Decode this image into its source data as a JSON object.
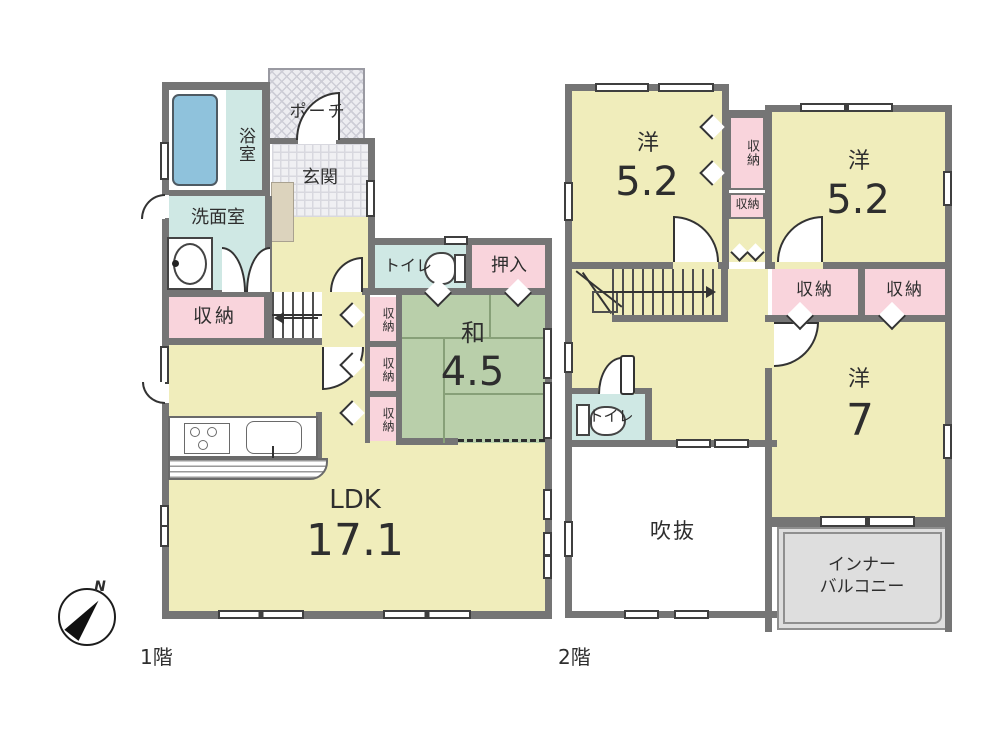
{
  "compass": {
    "north_label": "N"
  },
  "floor1": {
    "floor_label": "1階",
    "bath": "浴室",
    "washroom": "洗面室",
    "porch": "ポーチ",
    "entrance": "玄関",
    "toilet": "トイレ",
    "oshiire": "押入",
    "storage": "収納",
    "storage_small_1": "収納",
    "storage_small_2": "収納",
    "storage_small_3": "収納",
    "japanese_room": "和",
    "japanese_room_size": "4.5",
    "ldk": "LDK",
    "ldk_size": "17.1"
  },
  "floor2": {
    "floor_label": "2階",
    "western_a": "洋",
    "western_a_size": "5.2",
    "storage_tall": "収納",
    "storage_small": "収納",
    "western_b": "洋",
    "western_b_size": "5.2",
    "storage_a": "収納",
    "storage_b": "収納",
    "western_c": "洋",
    "western_c_size": "7",
    "toilet": "トイレ",
    "void_space": "吹抜",
    "balcony_line1": "インナー",
    "balcony_line2": "バルコニー"
  },
  "colors": {
    "wall": "#757575",
    "room_yellow": "#f0edbb",
    "tatami_green": "#b9cfaa",
    "wet_area_cyan": "#cfe8e4",
    "storage_pink": "#f9d4dc",
    "bathtub_blue": "#8fc2dc",
    "balcony_gray": "#dedede"
  }
}
